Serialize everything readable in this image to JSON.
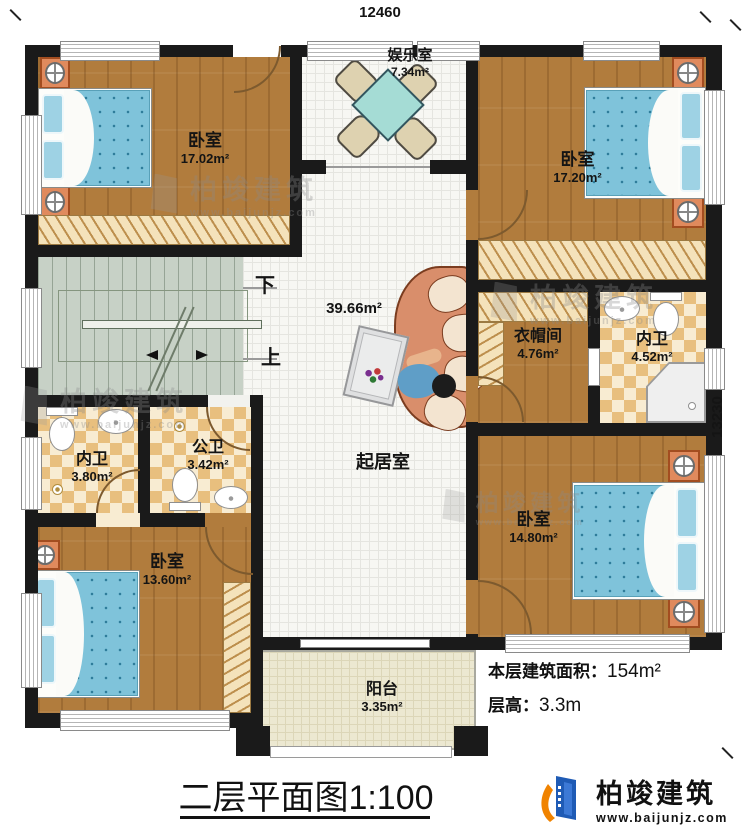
{
  "dimensions": {
    "top": "12460",
    "right": "13230"
  },
  "rooms": {
    "bedroom_tl": {
      "name": "卧室",
      "area": "17.02m²"
    },
    "entertainment": {
      "name": "娱乐室",
      "area": "7.34m²"
    },
    "bedroom_tr": {
      "name": "卧室",
      "area": "17.20m²"
    },
    "living": {
      "name": "起居室",
      "area": "39.66m²"
    },
    "cloakroom": {
      "name": "衣帽间",
      "area": "4.76m²"
    },
    "bath_right": {
      "name": "内卫",
      "area": "4.52m²"
    },
    "bath_left": {
      "name": "内卫",
      "area": "3.80m²"
    },
    "bath_public": {
      "name": "公卫",
      "area": "3.42m²"
    },
    "bedroom_bl": {
      "name": "卧室",
      "area": "13.60m²"
    },
    "bedroom_br": {
      "name": "卧室",
      "area": "14.80m²"
    },
    "balcony": {
      "name": "阳台",
      "area": "3.35m²"
    }
  },
  "stairs": {
    "down": "下",
    "up": "上"
  },
  "info": {
    "area_label": "本层建筑面积：",
    "area_value": "154m²",
    "height_label": "层高：",
    "height_value": "3.3m"
  },
  "title": "二层平面图1:100",
  "brand": {
    "name": "柏竣建筑",
    "url": "www.baijunjz.com"
  },
  "watermark": {
    "name": "柏竣建筑",
    "url": "www.baijunjz.com"
  },
  "colors": {
    "wall": "#1a1a1a",
    "wood": "#b17c3d",
    "tile": "#f7f7f3",
    "checker": "#e8bf7e",
    "stairs": "#c7d1c6",
    "balcony": "#ece8d1",
    "bed_blue": "#7fc3da",
    "nightstand_orange": "#e08a5d",
    "sofa_salmon": "#d98e6b",
    "table_teal": "#a5dcd5",
    "brand_blue": "#1f5bb5",
    "brand_orange": "#f08300"
  }
}
